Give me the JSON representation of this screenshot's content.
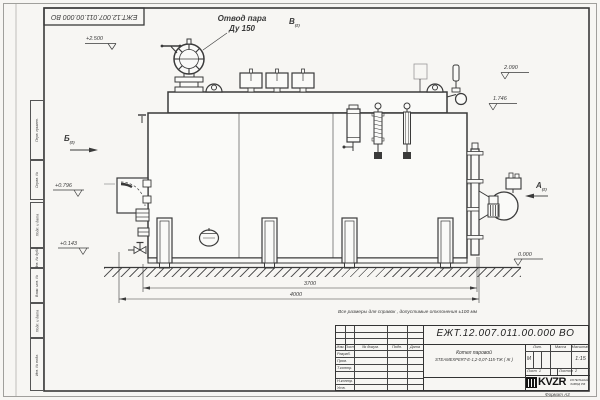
{
  "sheet": {
    "code_inverted": "ЕЖТ.12.007.011.00.000  ВО",
    "reference_note": "Все размеры для справок , допустимые отклонения  ±100  мм",
    "format_note": "Формат  А3"
  },
  "margin_stamps": [
    "Перв. примен.",
    "Справ. №",
    "Подп. и дата",
    "Инв. № дубл.",
    "Взам. инв. №",
    "Подп. и дата",
    "Инв. № подл."
  ],
  "annotations": {
    "steam_outlet_l1": "Отвод пара",
    "steam_outlet_l2": "Ду 150",
    "view_a": "А",
    "view_b": "Б",
    "view_v": "В",
    "view_sub": "(2)",
    "elev_2500": "+2.500",
    "elev_2090": "2.090",
    "elev_1746": "1.746",
    "elev_0796": "+0.796",
    "elev_0143": "+0.143",
    "elev_0000": "0.000",
    "dim_3700": "3700",
    "dim_4000": "4000"
  },
  "title_block": {
    "code": "ЕЖТ.12.007.011.00.000  ВО",
    "product_name_l1": "Котел паровой",
    "product_name_l2": "STEAMEXPERT-Е-1,2-0,07-115-ТЖ ( Ж )",
    "col_izm": "Изм.",
    "col_list": "Лист",
    "col_doc": "№ докум.",
    "col_podp": "Подп.",
    "col_data": "Дата",
    "row_razrab": "Разраб.",
    "row_prov": "Пров.",
    "row_tkontr": "Т.контр.",
    "row_nkontr": "Н.контр.",
    "row_utv": "Утв.",
    "lit_label": "Лит.",
    "lit_value": "М",
    "mass_label": "Масса",
    "scale_label": "Масштаб",
    "scale_value": "1:15",
    "sheet_label": "Лист",
    "sheet_value": "1",
    "sheets_label": "Листов",
    "sheets_value": "2",
    "logo_text": "KVZR",
    "logo_sub1": "КОТЕЛЬНЫЙ",
    "logo_sub2": "ЗАВОД РФ"
  },
  "colors": {
    "line": "#3a3a3a",
    "paper": "#fafaf8",
    "logo": "#141414"
  }
}
